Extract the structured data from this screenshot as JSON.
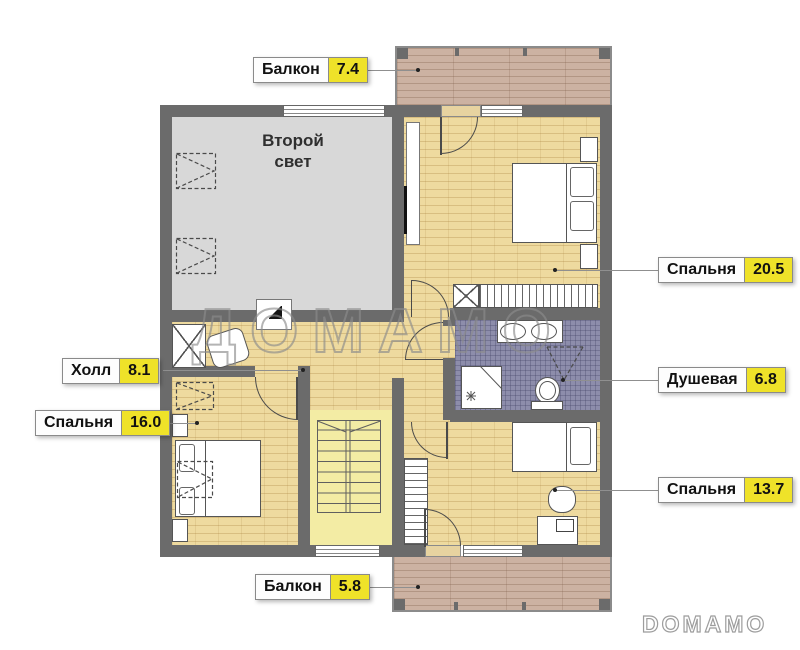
{
  "plan": {
    "second_light": {
      "line1": "Второй",
      "line2": "свет"
    }
  },
  "labels": {
    "balcony_top": {
      "name": "Балкон",
      "area": "7.4"
    },
    "bedroom_right": {
      "name": "Спальня",
      "area": "20.5"
    },
    "shower": {
      "name": "Душевая",
      "area": "6.8"
    },
    "bedroom_bottom_right": {
      "name": "Спальня",
      "area": "13.7"
    },
    "hall": {
      "name": "Холл",
      "area": "8.1"
    },
    "bedroom_left": {
      "name": "Спальня",
      "area": "16.0"
    },
    "balcony_bottom": {
      "name": "Балкон",
      "area": "5.8"
    }
  },
  "watermarks": {
    "center": "ДОМАМО",
    "corner": "DOMAMO"
  },
  "colors": {
    "wall": "#6b6b6b",
    "wood_floor": "#eeda9f",
    "tile_floor": "#8d8dab",
    "second_light_floor": "#d8d8d8",
    "stairs_floor": "#f3eca4",
    "balcony_deck": "#ccb2a2",
    "label_value_bg": "#efe229"
  }
}
